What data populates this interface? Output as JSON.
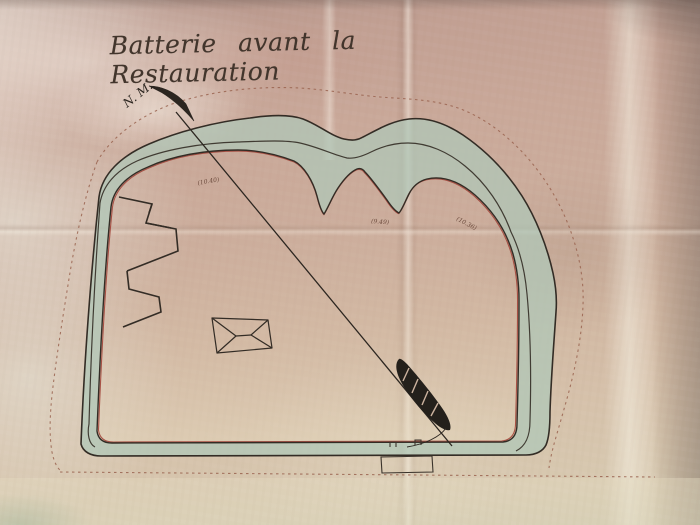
{
  "plan": {
    "title": "Batterie avant la Restauration",
    "north_label": "N. M.",
    "elevations": {
      "left": "(10.40)",
      "center": "(9.49)",
      "right": "(10.36)"
    },
    "colors": {
      "ink": "#332c25",
      "crest_red": "#a2453a",
      "glacis_green": "#afc7b8",
      "boundary_dash": "#9a6450",
      "paper": "#cbac9b"
    }
  }
}
